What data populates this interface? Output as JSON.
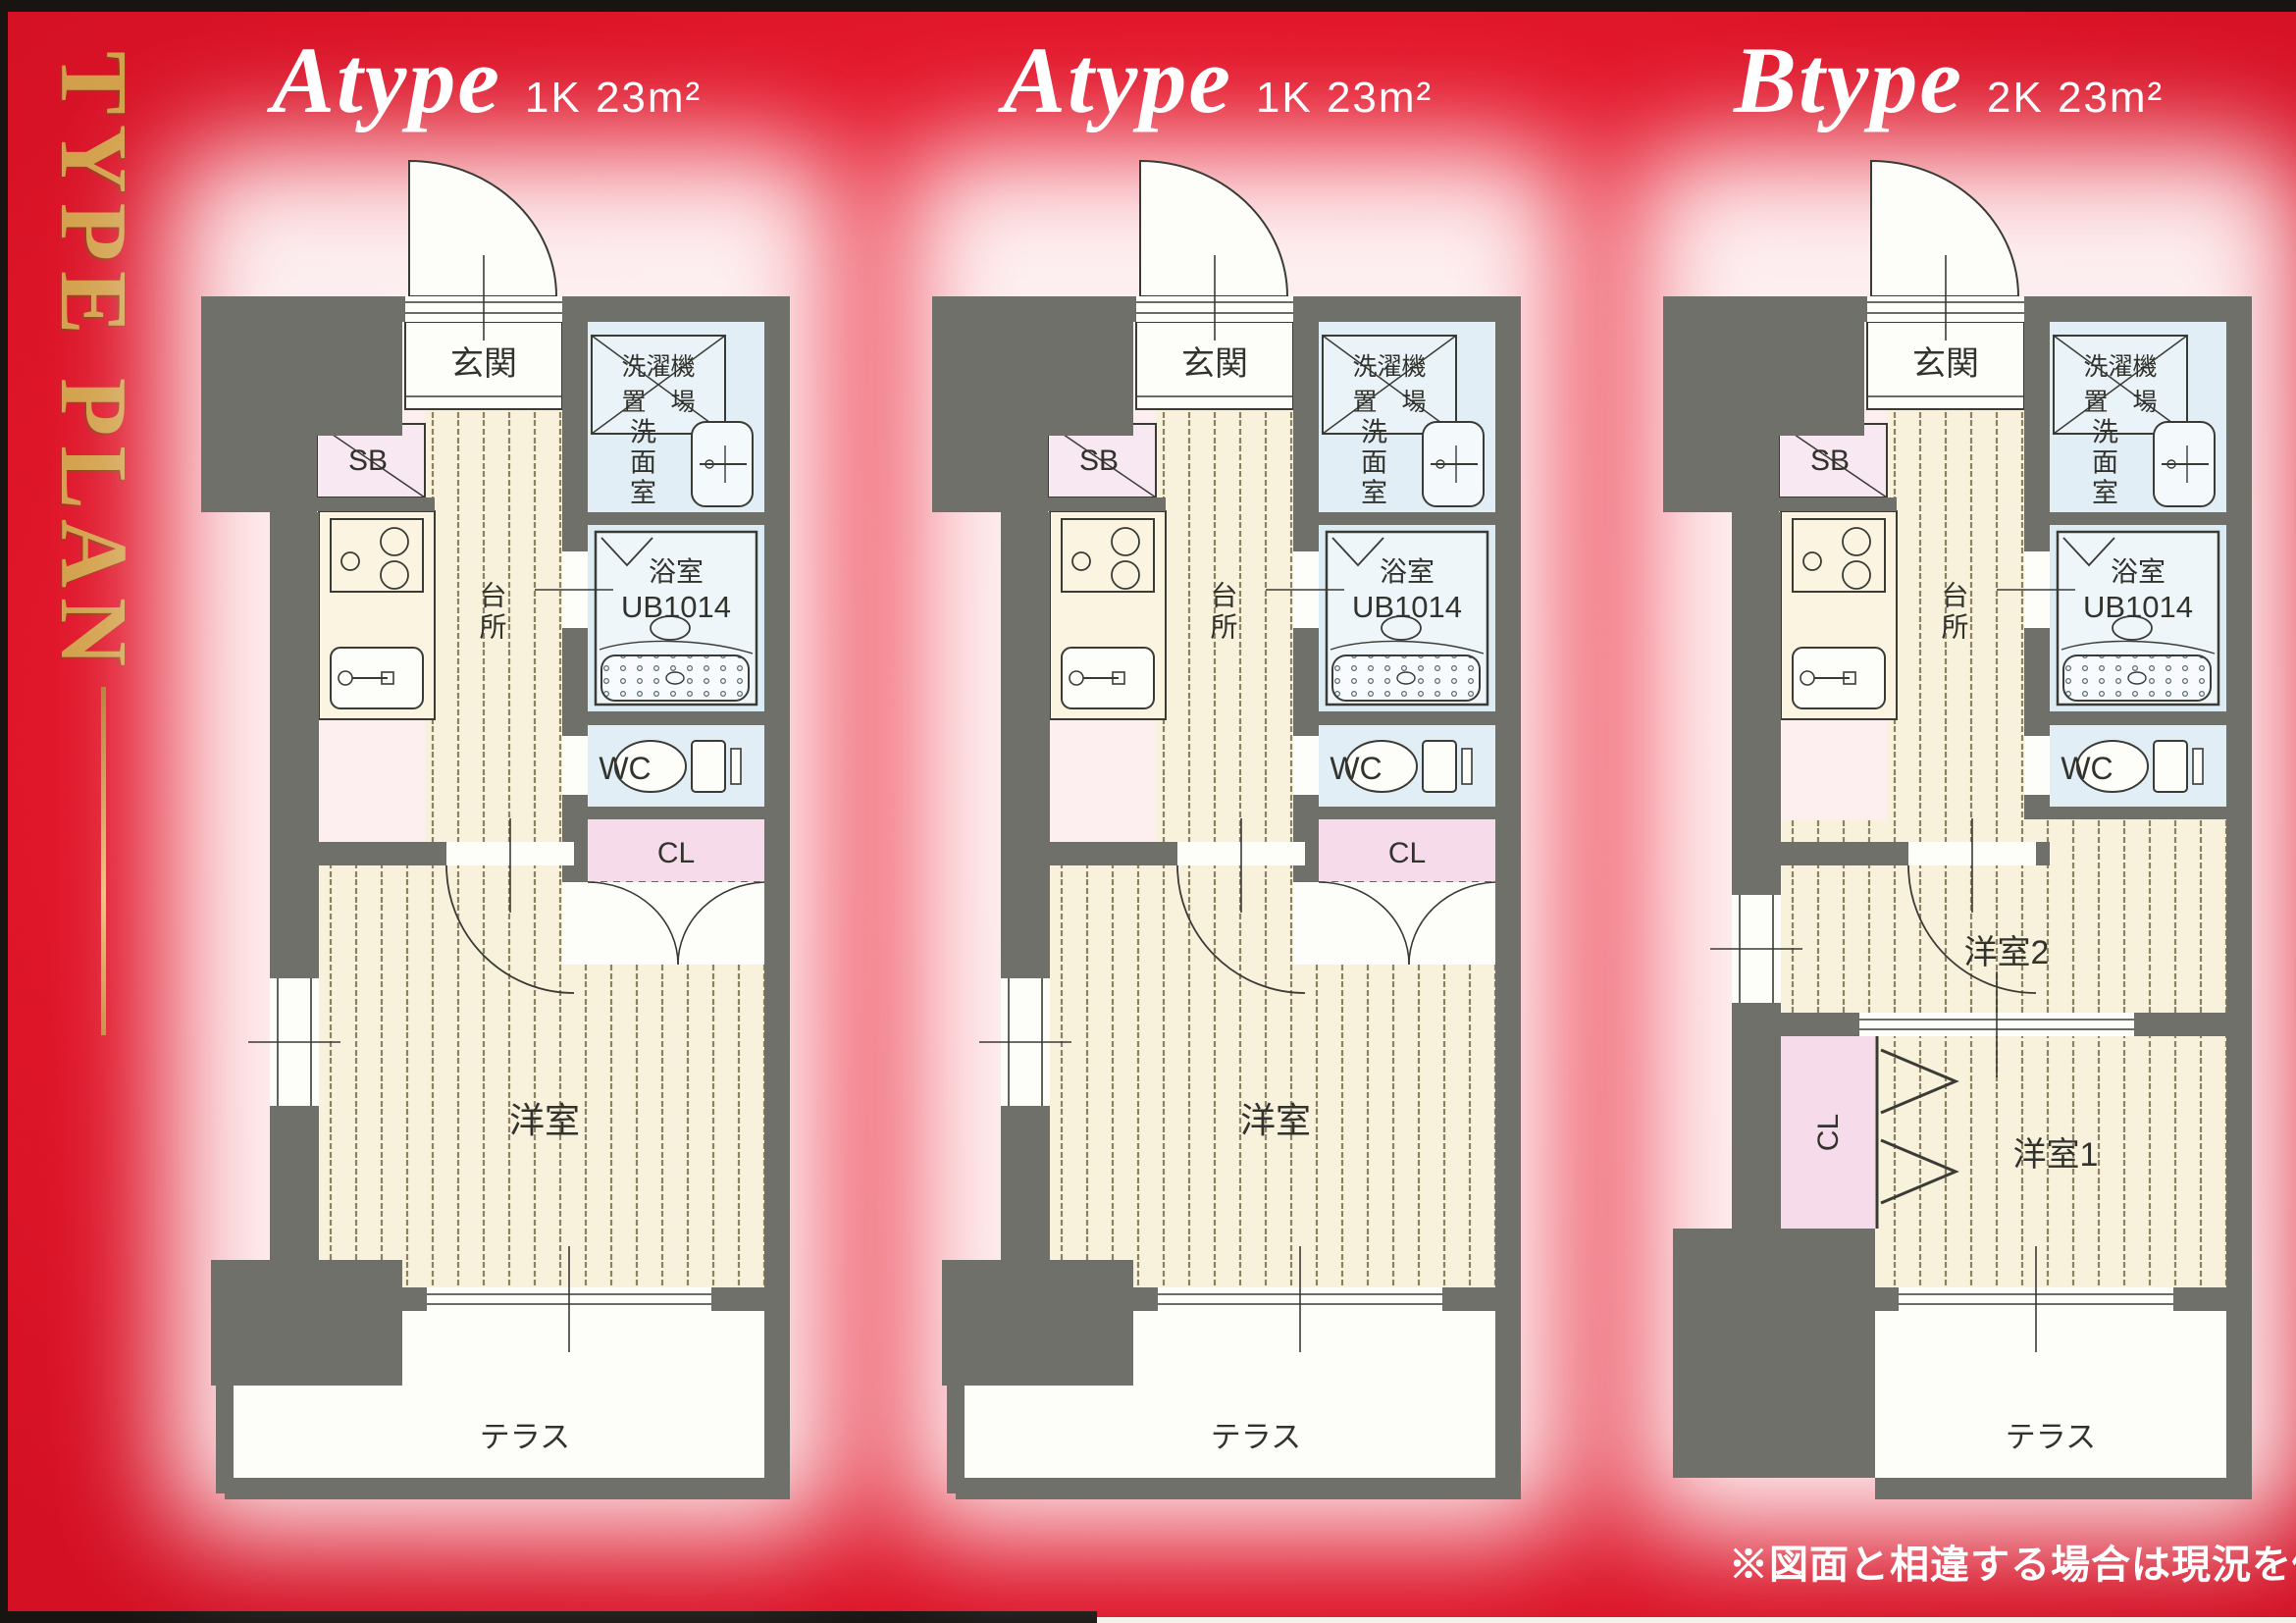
{
  "page": {
    "sidebar_title": "TYPE PLAN",
    "footnote": "※図面と相違する場合は現況を優先いたします。",
    "colors": {
      "background_red": "#e6192d",
      "gold": "#d2a04a",
      "wall_gray": "#70706a",
      "floor_cream": "#f8f2dc",
      "floor_stripe": "#8a8260",
      "wet_blue": "#e1eef5",
      "shoebox_pink": "#f7e8f2",
      "closet_pink": "#f6dcea",
      "line_dark": "#3b3b36"
    }
  },
  "plans": [
    {
      "name": "Atype",
      "spec": "1K 23m²",
      "rooms": {
        "entrance": "玄関",
        "shoebox": "SB",
        "kitchen": "台所",
        "washer_line1": "洗濯機",
        "washer_line2": "置　場",
        "washroom": "洗面室",
        "bath_name": "浴室",
        "bath_model": "UB1014",
        "wc": "WC",
        "closet": "CL",
        "living": "洋室",
        "terrace": "テラス"
      }
    },
    {
      "name": "Atype",
      "spec": "1K 23m²",
      "rooms": {
        "entrance": "玄関",
        "shoebox": "SB",
        "kitchen": "台所",
        "washer_line1": "洗濯機",
        "washer_line2": "置　場",
        "washroom": "洗面室",
        "bath_name": "浴室",
        "bath_model": "UB1014",
        "wc": "WC",
        "closet": "CL",
        "living": "洋室",
        "terrace": "テラス"
      }
    },
    {
      "name": "Btype",
      "spec": "2K 23m²",
      "rooms": {
        "entrance": "玄関",
        "shoebox": "SB",
        "kitchen": "台所",
        "washer_line1": "洗濯機",
        "washer_line2": "置　場",
        "washroom": "洗面室",
        "bath_name": "浴室",
        "bath_model": "UB1014",
        "wc": "WC",
        "closet": "CL",
        "room2": "洋室2",
        "room1": "洋室1",
        "terrace": "テラス"
      }
    }
  ]
}
